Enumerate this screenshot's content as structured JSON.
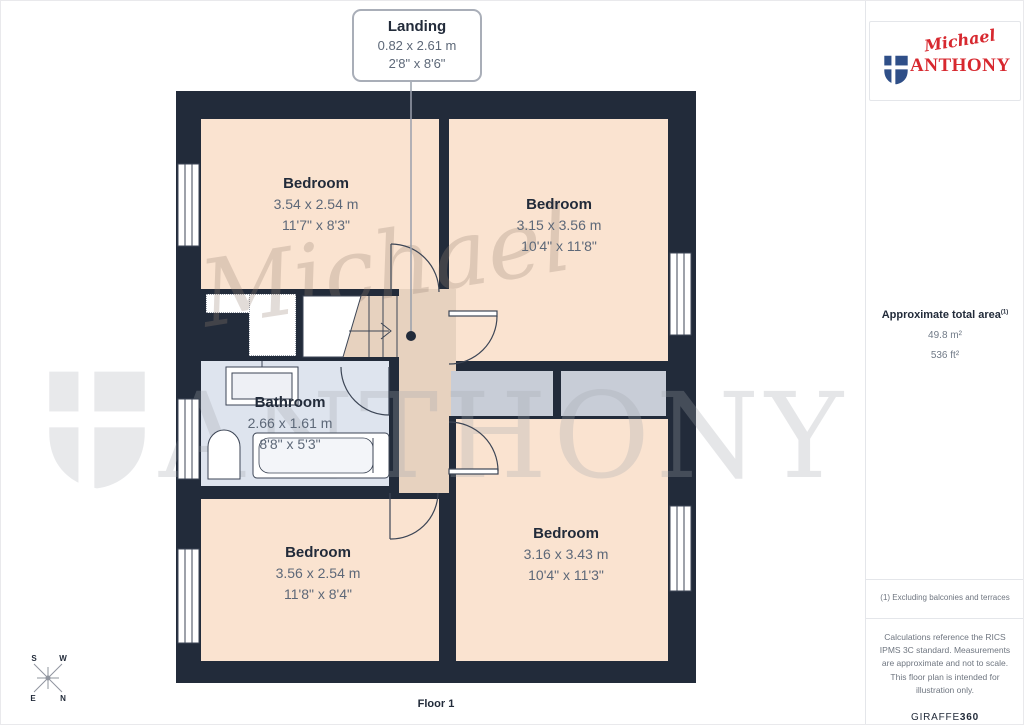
{
  "callout": {
    "title": "Landing",
    "metric": "0.82 x 2.61 m",
    "imperial": "2'8\" x 8'6\""
  },
  "rooms": [
    {
      "name": "Bedroom",
      "metric": "3.54 x 2.54 m",
      "imperial": "11'7\" x 8'3\""
    },
    {
      "name": "Bedroom",
      "metric": "3.15 x 3.56 m",
      "imperial": "10'4\" x 11'8\""
    },
    {
      "name": "Bathroom",
      "metric": "2.66 x 1.61 m",
      "imperial": "8'8\" x 5'3\""
    },
    {
      "name": "Bedroom",
      "metric": "3.56 x 2.54 m",
      "imperial": "11'8\" x 8'4\""
    },
    {
      "name": "Bedroom",
      "metric": "3.16 x 3.43 m",
      "imperial": "10'4\" x 11'3\""
    }
  ],
  "floor_label": "Floor 1",
  "compass": {
    "n": "N",
    "e": "E",
    "s": "S",
    "w": "W"
  },
  "watermark": {
    "script": "Michael",
    "name": "ANTHONY"
  },
  "sidebar": {
    "logo": {
      "script": "Michael",
      "name": "ANTHONY"
    },
    "area": {
      "label": "Approximate total area",
      "note_ref": "(1)",
      "metric": "49.8 m²",
      "imperial": "536 ft²"
    },
    "footnote": "(1) Excluding balconies and terraces",
    "disclaimer": "Calculations reference the RICS IPMS 3C standard. Measurements are approximate and not to scale. This floor plan is intended for illustration only.",
    "brand": {
      "name": "GIRAFFE",
      "suffix": "360"
    }
  },
  "colors": {
    "wall": "#222b3a",
    "room_fill": "#fae3d0",
    "hall_fill": "#e7d2bf",
    "bathroom_fill": "#dee4ee",
    "storage_fill": "#c8cdd7",
    "brand_red": "#d7282f",
    "shield_blue": "#2f4f88"
  }
}
